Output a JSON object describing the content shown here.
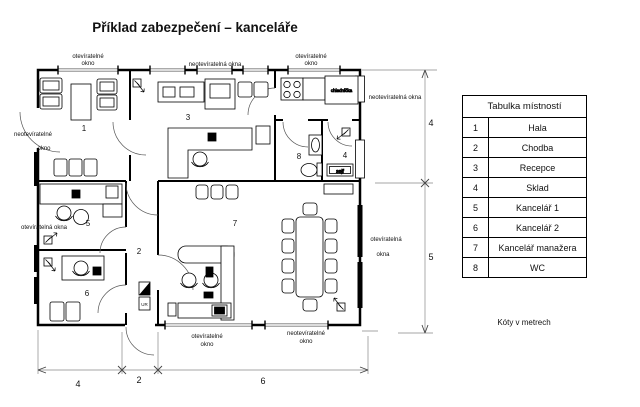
{
  "title": "Příklad zabezpečení – kanceláře",
  "note": "Kóty v metrech",
  "room_table": {
    "header": "Tabulka místností",
    "rows": [
      {
        "num": "1",
        "name": "Hala"
      },
      {
        "num": "2",
        "name": "Chodba"
      },
      {
        "num": "3",
        "name": "Recepce"
      },
      {
        "num": "4",
        "name": "Sklad"
      },
      {
        "num": "5",
        "name": "Kancelář 1"
      },
      {
        "num": "6",
        "name": "Kancelář 2"
      },
      {
        "num": "7",
        "name": "Kancelář manažera"
      },
      {
        "num": "8",
        "name": "WC"
      }
    ]
  },
  "rooms": {
    "r1": "1",
    "r2": "2",
    "r3": "3",
    "r4": "4",
    "r5": "5",
    "r6": "6",
    "r7": "7",
    "r8": "8"
  },
  "labels": {
    "win_top_left_1": "otevíratelné",
    "win_top_left_2": "okno",
    "win_top_mid": "neotevíratelná okna",
    "win_top_right_1": "otevíratelné",
    "win_top_right_2": "okno",
    "win_left_top_1": "neotevíratelné",
    "win_left_top_2": "okno",
    "win_left_mid": "otevíratelná okna",
    "win_right_top": "neotevíratelná okna",
    "win_right_mid_1": "otevíratelná",
    "win_right_mid_2": "okna",
    "win_bottom_left_1": "otevíratelné",
    "win_bottom_left_2": "okno",
    "win_bottom_right_1": "neotevíratelné",
    "win_bottom_right_2": "okno",
    "fridge": "chladnička",
    "safe": "sejf",
    "panel": "UR"
  },
  "dimensions": {
    "bottom_1": "4",
    "bottom_2": "2",
    "bottom_3": "6",
    "right_1": "4",
    "right_2": "5"
  },
  "colors": {
    "ink": "#000000",
    "dim": "#888888",
    "background": "#ffffff"
  }
}
